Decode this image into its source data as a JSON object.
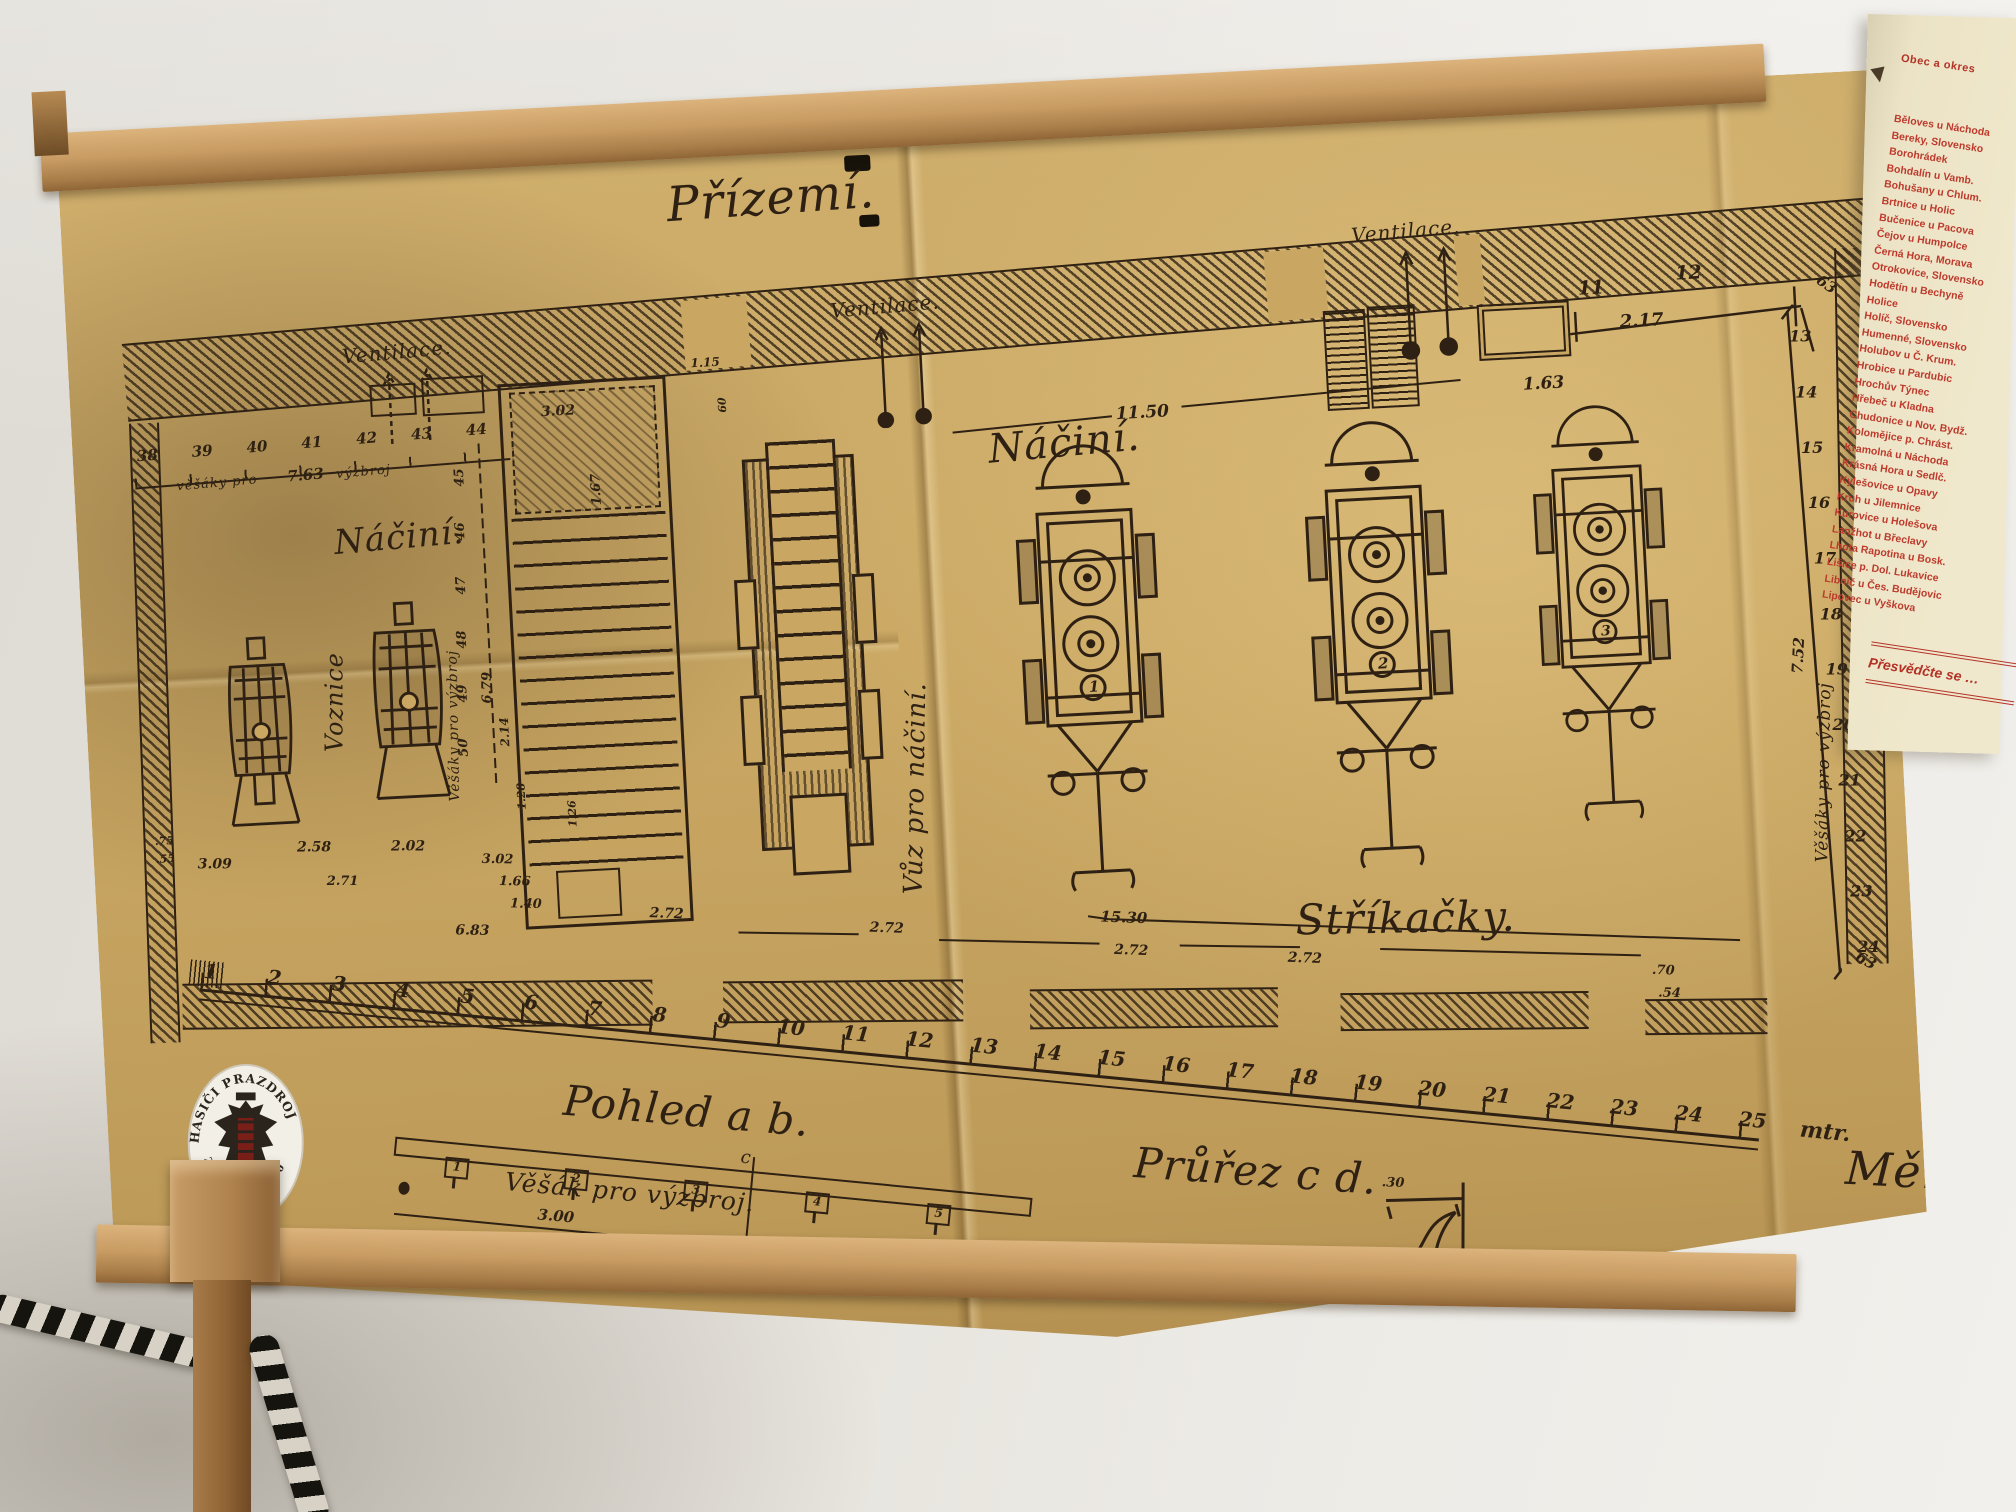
{
  "drawing": {
    "title": "Přízemí.",
    "script_labels": [
      {
        "t": "Přízemí.",
        "x": 606,
        "y": 44,
        "s": 48,
        "r": -1
      },
      {
        "t": "Ventilace.",
        "x": 274,
        "y": 194,
        "s": 20,
        "r": -2
      },
      {
        "t": "Ventilace.",
        "x": 764,
        "y": 174,
        "s": 20,
        "r": -2
      },
      {
        "t": "Ventilace.",
        "x": 1288,
        "y": 126,
        "s": 20,
        "r": -2
      },
      {
        "t": "Náčiní.",
        "x": 256,
        "y": 372,
        "s": 34,
        "r": -2
      },
      {
        "t": "Náčiní.",
        "x": 914,
        "y": 310,
        "s": 40,
        "r": -2
      },
      {
        "t": "Voznice",
        "x": 232,
        "y": 600,
        "s": 24,
        "r": -87
      },
      {
        "t": "Vůz pro náčiní.",
        "x": 802,
        "y": 772,
        "s": 26,
        "r": -86
      },
      {
        "t": "Stříkačky.",
        "x": 1198,
        "y": 794,
        "s": 42,
        "r": 2
      },
      {
        "t": "Pohled  a b.",
        "x": 460,
        "y": 936,
        "s": 42,
        "r": 8
      },
      {
        "t": "Průřez  c d.",
        "x": 1026,
        "y": 1028,
        "s": 42,
        "r": 7
      },
      {
        "t": "Věšák pro výzbroj.",
        "x": 396,
        "y": 1024,
        "s": 25,
        "r": 8
      },
      {
        "t": "Měř",
        "x": 1736,
        "y": 1068,
        "s": 46,
        "r": 6
      },
      {
        "t": "Věšáky pro výzbroj",
        "x": 1716,
        "y": 788,
        "s": 17,
        "r": -86
      },
      {
        "t": "Věšáky pro výzbroj",
        "x": 356,
        "y": 656,
        "s": 14,
        "r": -88
      },
      {
        "t": "věšáky pro",
        "x": 102,
        "y": 320,
        "s": 13,
        "r": -2
      },
      {
        "t": "výzbroj",
        "x": 262,
        "y": 316,
        "s": 13,
        "r": -2
      },
      {
        "t": "c",
        "x": 632,
        "y": 1016,
        "s": 18,
        "r": 8
      },
      {
        "t": "d",
        "x": 618,
        "y": 1132,
        "s": 18,
        "r": 8
      }
    ],
    "dims": [
      {
        "t": "11.50",
        "x": 1044,
        "y": 294,
        "s": 17
      },
      {
        "t": "11",
        "x": 1512,
        "y": 192,
        "s": 19
      },
      {
        "t": "12",
        "x": 1610,
        "y": 182,
        "s": 19
      },
      {
        "t": "2.17",
        "x": 1552,
        "y": 228,
        "s": 18
      },
      {
        "t": "1.63",
        "x": 1452,
        "y": 286,
        "s": 17
      },
      {
        "t": "63",
        "x": 1758,
        "y": 198,
        "s": 15,
        "r": 38
      },
      {
        "t": "63",
        "x": 1760,
        "y": 876,
        "s": 15,
        "r": 30
      },
      {
        "t": "7.52",
        "x": 1702,
        "y": 598,
        "s": 15,
        "r": -84
      },
      {
        "t": "13",
        "x": 1721,
        "y": 252,
        "s": 16,
        "r": 3
      },
      {
        "t": "14",
        "x": 1724,
        "y": 308,
        "s": 16,
        "r": 3
      },
      {
        "t": "15",
        "x": 1727,
        "y": 364,
        "s": 16,
        "r": 3
      },
      {
        "t": "16",
        "x": 1731,
        "y": 419,
        "s": 16,
        "r": 3
      },
      {
        "t": "17",
        "x": 1734,
        "y": 475,
        "s": 16,
        "r": 3
      },
      {
        "t": "18",
        "x": 1737,
        "y": 531,
        "s": 16,
        "r": 3
      },
      {
        "t": "19",
        "x": 1740,
        "y": 586,
        "s": 16,
        "r": 3
      },
      {
        "t": "20",
        "x": 1744,
        "y": 642,
        "s": 16,
        "r": 3
      },
      {
        "t": "21",
        "x": 1747,
        "y": 698,
        "s": 16,
        "r": 3
      },
      {
        "t": "22",
        "x": 1750,
        "y": 754,
        "s": 16,
        "r": 3
      },
      {
        "t": "23",
        "x": 1753,
        "y": 809,
        "s": 16,
        "r": 3
      },
      {
        "t": "24",
        "x": 1757,
        "y": 865,
        "s": 16,
        "r": 3
      },
      {
        "t": "45",
        "x": 378,
        "y": 342,
        "s": 13,
        "r": -90
      },
      {
        "t": "46",
        "x": 376,
        "y": 396,
        "s": 13,
        "r": -90
      },
      {
        "t": "47",
        "x": 374,
        "y": 450,
        "s": 13,
        "r": -90
      },
      {
        "t": "48",
        "x": 372,
        "y": 504,
        "s": 13,
        "r": -90
      },
      {
        "t": "49",
        "x": 370,
        "y": 558,
        "s": 13,
        "r": -90
      },
      {
        "t": "50",
        "x": 368,
        "y": 612,
        "s": 13,
        "r": -90
      },
      {
        "t": "6.79",
        "x": 394,
        "y": 560,
        "s": 13,
        "r": -88
      },
      {
        "t": "7.63",
        "x": 213,
        "y": 314,
        "s": 15,
        "r": -2
      },
      {
        "t": "3.02",
        "x": 470,
        "y": 264,
        "s": 14
      },
      {
        "t": "1.67",
        "x": 514,
        "y": 368,
        "s": 13,
        "r": -90
      },
      {
        "t": "1.15",
        "x": 622,
        "y": 224,
        "s": 12
      },
      {
        "t": "60",
        "x": 645,
        "y": 282,
        "s": 11,
        "r": -90
      },
      {
        "t": "2.14",
        "x": 410,
        "y": 604,
        "s": 12,
        "r": -90
      },
      {
        "t": "1.28",
        "x": 424,
        "y": 668,
        "s": 11,
        "r": -90
      },
      {
        "t": "1.26",
        "x": 474,
        "y": 688,
        "s": 11,
        "r": -90
      },
      {
        "t": "3.09",
        "x": 104,
        "y": 698,
        "s": 14,
        "r": 3
      },
      {
        "t": "2.58",
        "x": 204,
        "y": 686,
        "s": 14,
        "r": 3
      },
      {
        "t": "2.02",
        "x": 298,
        "y": 690,
        "s": 14,
        "r": 3
      },
      {
        "t": ".75",
        "x": 62,
        "y": 674,
        "s": 11
      },
      {
        "t": ".55",
        "x": 62,
        "y": 692,
        "s": 11
      },
      {
        "t": "2.71",
        "x": 232,
        "y": 722,
        "s": 13,
        "r": 3
      },
      {
        "t": "3.02",
        "x": 388,
        "y": 708,
        "s": 13,
        "r": 4
      },
      {
        "t": "1.66",
        "x": 404,
        "y": 731,
        "s": 13,
        "r": 4
      },
      {
        "t": "1.40",
        "x": 414,
        "y": 754,
        "s": 13,
        "r": 4
      },
      {
        "t": "6.83",
        "x": 358,
        "y": 777,
        "s": 14,
        "r": 4
      },
      {
        "t": "2.72",
        "x": 553,
        "y": 770,
        "s": 14,
        "r": 5
      },
      {
        "t": "2.72",
        "x": 772,
        "y": 796,
        "s": 14,
        "r": 5
      },
      {
        "t": "2.72",
        "x": 1015,
        "y": 831,
        "s": 14,
        "r": 5
      },
      {
        "t": "2.72",
        "x": 1188,
        "y": 848,
        "s": 14,
        "r": 5
      },
      {
        "t": "15.30",
        "x": 1003,
        "y": 796,
        "s": 15,
        "r": 5
      },
      {
        "t": ".70",
        "x": 1551,
        "y": 880,
        "s": 13,
        "r": 5
      },
      {
        "t": ".54",
        "x": 1556,
        "y": 903,
        "s": 13,
        "r": 5
      },
      {
        "t": "3.00",
        "x": 426,
        "y": 1064,
        "s": 15,
        "r": 8
      },
      {
        "t": ".30",
        "x": 1270,
        "y": 1078,
        "s": 13,
        "r": 5
      }
    ],
    "ruler": {
      "marks": [
        {
          "t": "1",
          "x": 2
        },
        {
          "t": "2",
          "x": 66
        },
        {
          "t": "3",
          "x": 131
        },
        {
          "t": "4",
          "x": 195
        },
        {
          "t": "5",
          "x": 260
        },
        {
          "t": "6",
          "x": 324
        },
        {
          "t": "7",
          "x": 388
        },
        {
          "t": "8",
          "x": 453
        },
        {
          "t": "9",
          "x": 517
        },
        {
          "t": "10",
          "x": 578
        },
        {
          "t": "11",
          "x": 643
        },
        {
          "t": "12",
          "x": 707
        },
        {
          "t": "13",
          "x": 772
        },
        {
          "t": "14",
          "x": 836
        },
        {
          "t": "15",
          "x": 900
        },
        {
          "t": "16",
          "x": 965
        },
        {
          "t": "17",
          "x": 1029
        },
        {
          "t": "18",
          "x": 1093
        },
        {
          "t": "19",
          "x": 1158
        },
        {
          "t": "20",
          "x": 1222
        },
        {
          "t": "21",
          "x": 1287
        },
        {
          "t": "22",
          "x": 1351
        },
        {
          "t": "23",
          "x": 1415
        },
        {
          "t": "24",
          "x": 1480
        },
        {
          "t": "25",
          "x": 1544
        },
        {
          "t": "mtr.",
          "x": 1606,
          "c": "mtr"
        }
      ]
    },
    "miniruler": {
      "marks": [
        {
          "t": "38",
          "x": 4
        },
        {
          "t": "39",
          "x": 59
        },
        {
          "t": "40",
          "x": 114
        },
        {
          "t": "41",
          "x": 169
        },
        {
          "t": "42",
          "x": 224
        },
        {
          "t": "43",
          "x": 279
        },
        {
          "t": "44",
          "x": 334
        }
      ]
    },
    "hook_tabs": [
      {
        "t": "1",
        "x": 52
      },
      {
        "t": "2",
        "x": 172
      },
      {
        "t": "3",
        "x": 292
      },
      {
        "t": "4",
        "x": 414
      },
      {
        "t": "5",
        "x": 536
      }
    ],
    "engines": [
      {
        "n": "1",
        "x": 922,
        "y": 330
      },
      {
        "n": "2",
        "x": 1212,
        "y": 322
      },
      {
        "n": "3",
        "x": 1442,
        "y": 318,
        "sc": 0.93
      }
    ]
  },
  "badge": {
    "top": "HASIČI PRAZDROJ",
    "bottom": "ZALOŽENO 1880"
  },
  "poster": {
    "header": "Obec a okres",
    "places": [
      "Běloves u Náchoda",
      "Bereky, Slovensko",
      "Borohrádek",
      "Bohdalín u Vamb.",
      "Bohušany u Chlum.",
      "Brtnice u Holic",
      "Bučenice u Pacova",
      "Čejov u Humpolce",
      "Černá Hora, Morava",
      "Otrokovice, Slovensko",
      "Hodětín u Bechyně",
      "Holice",
      "Holíč, Slovensko",
      "Humenné, Slovensko",
      "Holubov u Č. Krum.",
      "Hrobice u Pardubic",
      "Hrochův Týnec",
      "Hřebeč u Kladna",
      "Chudonice u Nov. Bydž.",
      "Kolomějice p. Chrást.",
      "Kramolná u Náchoda",
      "Krásná Hora u Sedlč.",
      "Kylešovice u Opavy",
      "Kruh u Jilemnice",
      "Kurovice u Holešova",
      "Lanžhot u Břeclavy",
      "Lhota Rapotina u Bosk.",
      "Lišice p. Dol. Lukavice",
      "Libníč u Čes. Budějovic",
      "Lipovec u Vyškova"
    ],
    "footer": "Přesvědčte se …"
  }
}
